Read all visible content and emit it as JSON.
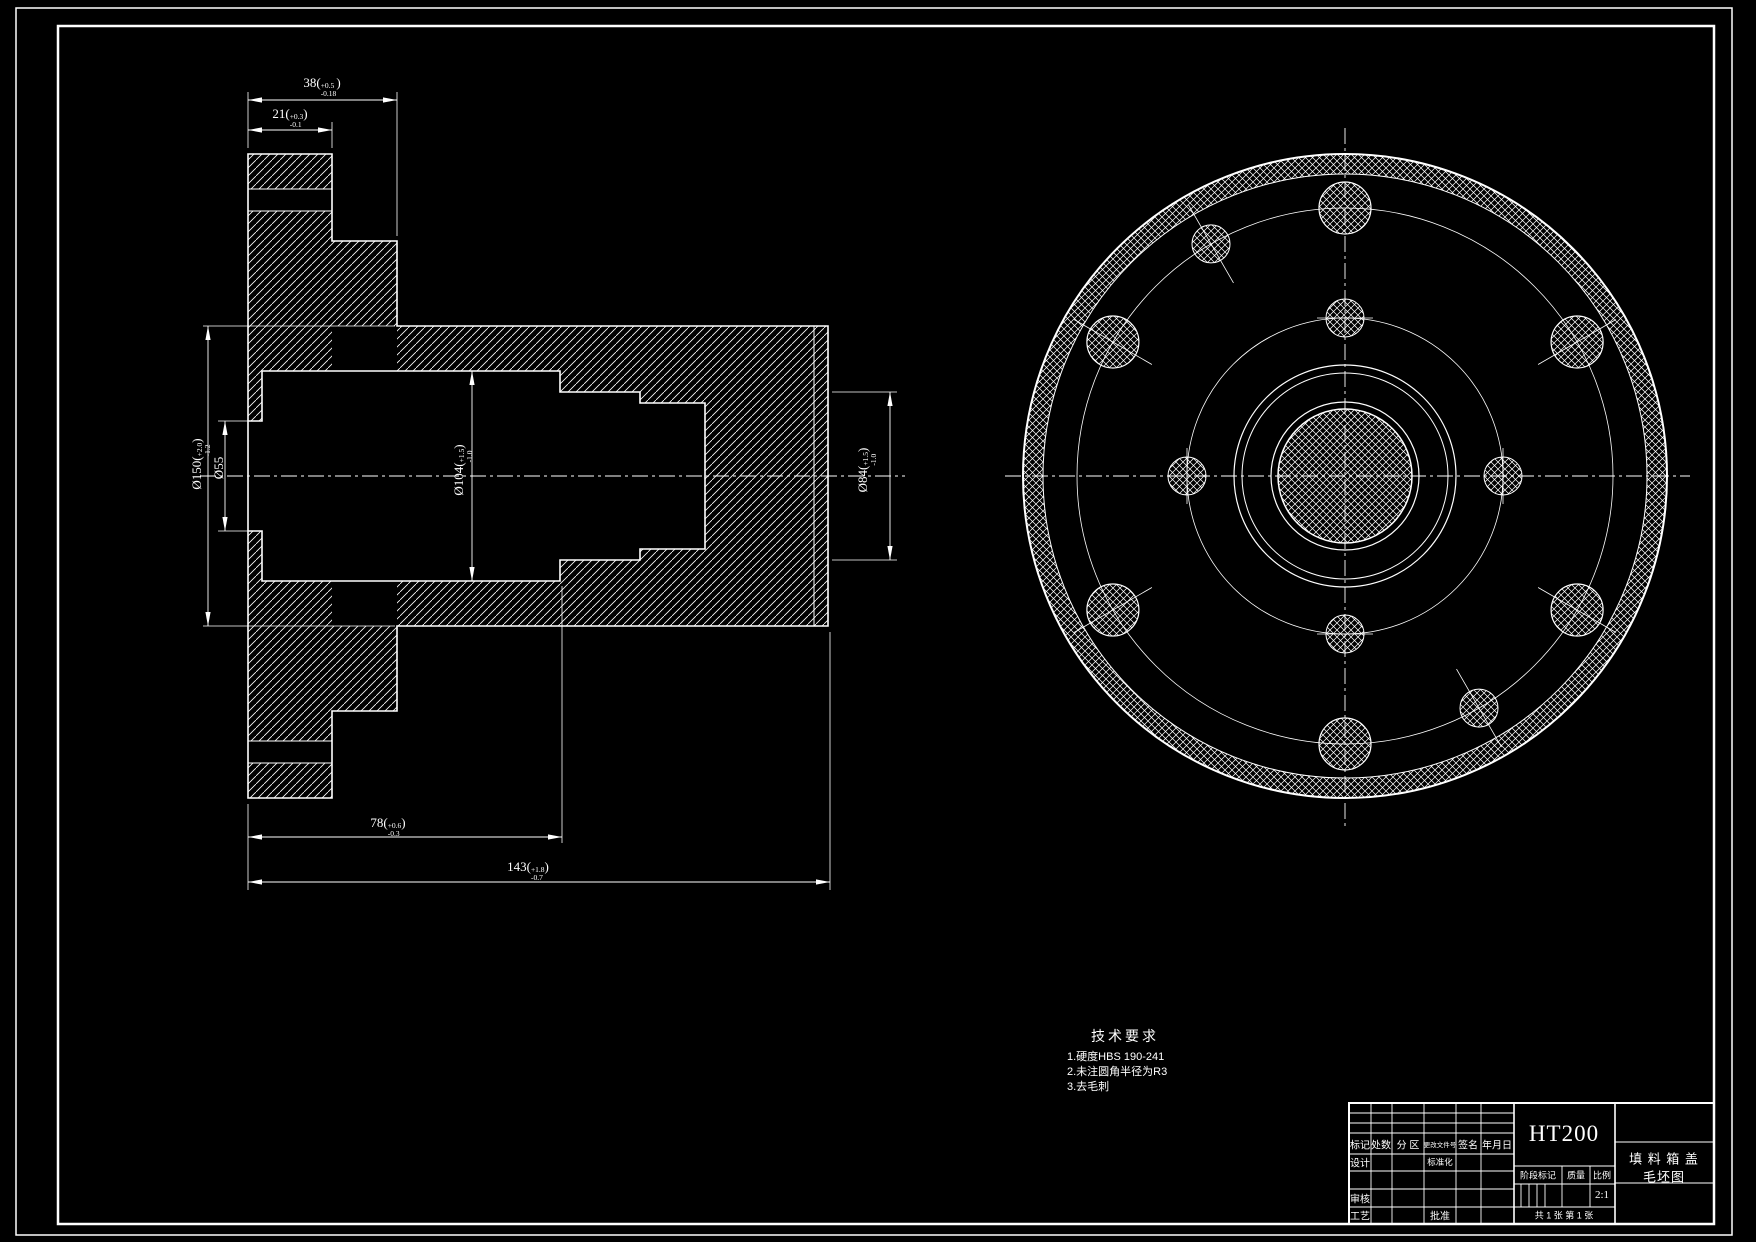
{
  "dims": {
    "d38": {
      "value": "38",
      "plus": "+0.5",
      "minus": "-0.18"
    },
    "d21": {
      "value": "21",
      "plus": "+0.3",
      "minus": "-0.1"
    },
    "d78": {
      "value": "78",
      "plus": "+0.6",
      "minus": "-0.3"
    },
    "d143": {
      "value": "143",
      "plus": "+1.8",
      "minus": "-0.7"
    },
    "d150": {
      "value": "Ø150",
      "plus": "+2.0",
      "minus": "-1.2"
    },
    "d104": {
      "value": "Ø104",
      "plus": "+1.5",
      "minus": "-1.0"
    },
    "d84": {
      "value": "Ø84",
      "plus": "+1.5",
      "minus": "-1.0"
    },
    "d55": {
      "value": "Ø55"
    }
  },
  "tech": {
    "title": "技术要求",
    "items": [
      "1.硬度HBS 190-241",
      "2.未注圆角半径为R3",
      "3.去毛刺"
    ]
  },
  "title_block": {
    "material": "HT200",
    "name_line1": "填 料 箱 盖",
    "name_line2": "毛坯图",
    "col_mark": "标记",
    "col_count": "处数",
    "col_zone": "分 区",
    "col_doc": "更改文件号",
    "col_sign": "签名",
    "col_date": "年月日",
    "row_design": "设计",
    "row_std": "标准化",
    "row_check": "审核",
    "row_process": "工艺",
    "row_approve": "批准",
    "stage": "阶段标记",
    "weight": "质量",
    "scale": "比例",
    "scale_value": "2:1",
    "sheet": "共 1 张 第 1 张"
  },
  "colors": {
    "line": "#ffffff",
    "background": "#000000"
  }
}
